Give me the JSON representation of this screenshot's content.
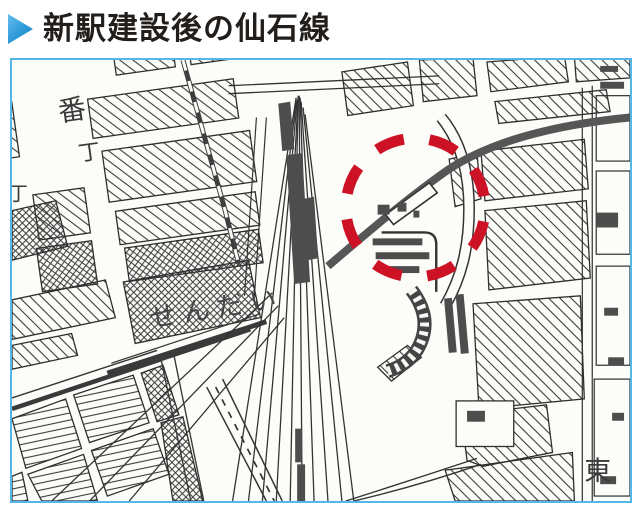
{
  "header": {
    "title": "新駅建設後の仙石線",
    "marker_icon": "triangle-right-icon",
    "marker_color": "#2e9ad8",
    "text_color": "#221e1b"
  },
  "map": {
    "type": "scanned-city-map",
    "border_color": "#54b7e8",
    "paper_color": "#fcfcf9",
    "ink_color": "#333333",
    "dark_fill": "#4d4d4d",
    "highlight_circle": {
      "style": "dashed",
      "color": "#cd1225",
      "meaning": "new-station-location"
    },
    "labels": {
      "ban": "番",
      "cho": "丁",
      "cho_edge": "丁",
      "station": "せんだい",
      "east": "東"
    }
  }
}
